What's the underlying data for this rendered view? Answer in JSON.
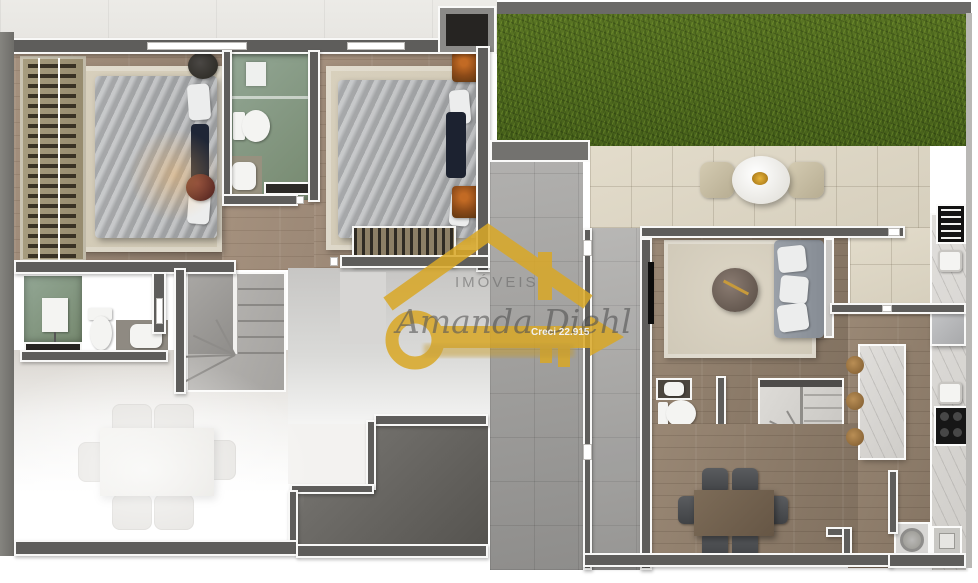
{
  "image": {
    "kind": "3d-floorplan-render",
    "panels": [
      {
        "name": "upper-floor-plan",
        "rooms": [
          "master-bedroom",
          "bathroom-1",
          "bedroom-2",
          "bathroom-2",
          "stairs",
          "hallway",
          "dining-area",
          "utility-room"
        ]
      },
      {
        "name": "ground-floor-plan",
        "rooms": [
          "backyard-lawn",
          "patio",
          "side-passage",
          "living-room",
          "guest-toilet",
          "stairs",
          "dining-room",
          "kitchen",
          "laundry"
        ]
      }
    ],
    "furniture_icons": [
      "double-bed-icon",
      "wardrobe-icon",
      "toilet-icon",
      "sink-icon",
      "shower-box-icon",
      "sofa-icon",
      "tv-icon",
      "coffee-table-icon",
      "dining-table-icon",
      "round-table-icon",
      "kitchen-island-icon",
      "stool-icon",
      "fridge-icon",
      "stove-icon",
      "grill-vent-icon",
      "washing-machine-icon",
      "utility-tank-icon",
      "plant-icon",
      "stairs-icon"
    ]
  },
  "watermark": {
    "script_name": "Amanda Diehl",
    "caps_word": "IMÓVEIS",
    "creci": "Creci 22.915",
    "icons": [
      "house-roof-icon",
      "key-icon"
    ]
  },
  "colors": {
    "gold": "#d9a827",
    "grass": "#4f6a1e",
    "wall": "#5e5d5b",
    "wood_floor": "#97846f",
    "tile_beige": "#ded7c5",
    "tile_gray": "#a6a5a3",
    "bath_glass_green": "#7e9383",
    "dark_room_floor": "#6b6965",
    "stairs_concrete": "#b4b2af",
    "stairs_marble": "#d8d6d2",
    "navy_pillow": "#1f2636"
  }
}
